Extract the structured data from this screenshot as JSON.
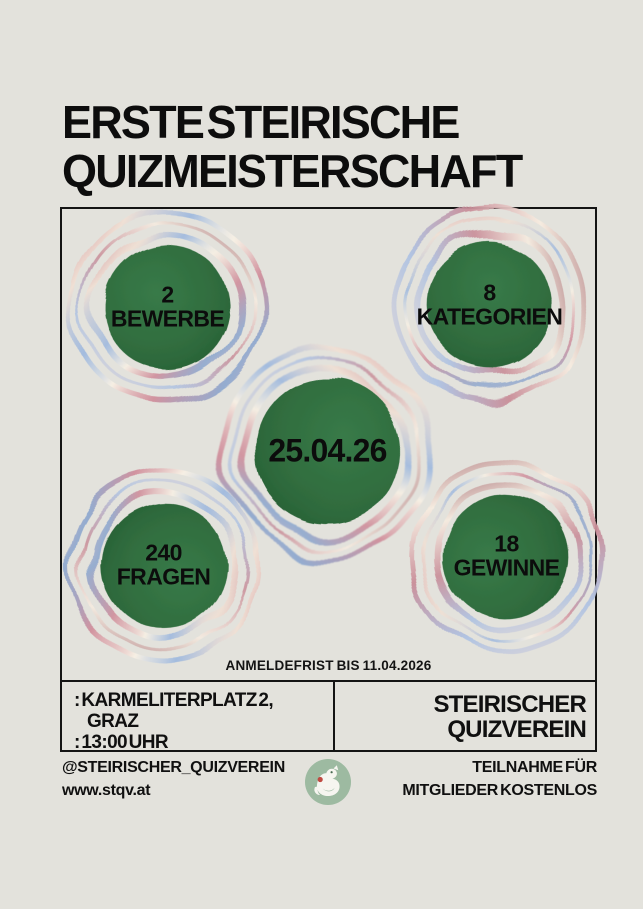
{
  "poster": {
    "title_line1": "ERSTE STEIRISCHE",
    "title_line2": "QUIZMEISTERSCHAFT",
    "deadline": "ANMELDEFRIST BIS 11.04.2026",
    "stats": {
      "bewerbe": {
        "value": "2",
        "label": "BEWERBE"
      },
      "kategorien": {
        "value": "8",
        "label": "KATEGORIEN"
      },
      "date": {
        "value": "25.04.26",
        "label": ""
      },
      "fragen": {
        "value": "240",
        "label": "FRAGEN"
      },
      "gewinne": {
        "value": "18",
        "label": "GEWINNE"
      }
    },
    "info": {
      "address_line1": ": KARMELITERPLATZ 2,",
      "address_line2": "GRAZ",
      "time_line": ": 13:00 UHR",
      "org_line1": "STEIRISCHER",
      "org_line2": "QUIZVEREIN"
    },
    "footer": {
      "instagram": "@STEIRISCHER_QUIZVEREIN",
      "website": "www.stqv.at",
      "note_line1": "TEILNAHME FÜR",
      "note_line2": "MITGLIEDER KOSTENLOS"
    },
    "colors": {
      "background": "#e3e2dc",
      "frame_border": "#141414",
      "circle_green": "#2f6b3d",
      "logo_green": "#9dbaa1",
      "ring_pink": "#cf8291",
      "ring_blue": "#a3bbdf",
      "ring_cream": "#f7f0e4",
      "text": "#101010"
    }
  }
}
